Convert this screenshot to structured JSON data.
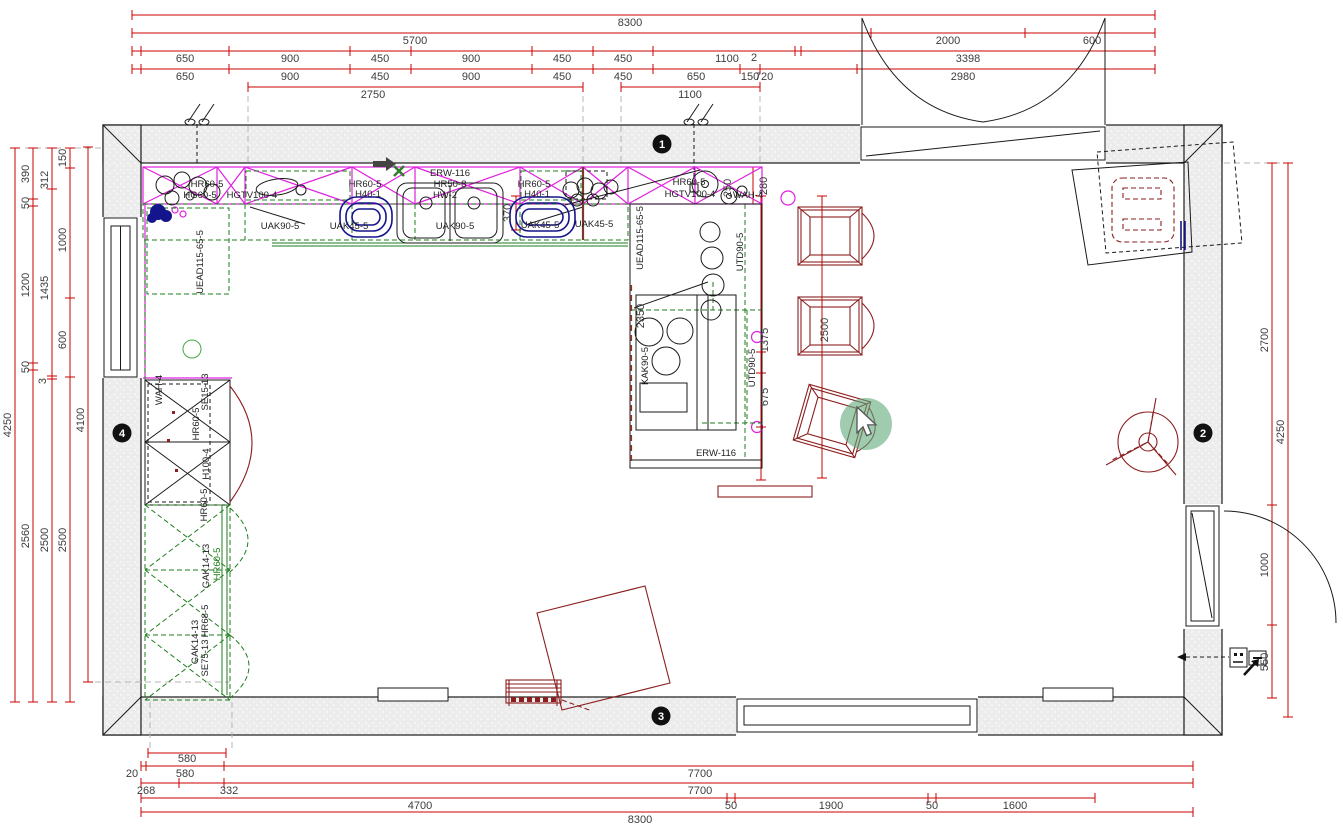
{
  "canvas": {
    "width": 1343,
    "height": 831,
    "background": "#ffffff"
  },
  "colors": {
    "dimension_red": "#c80000",
    "furniture_dark_red": "#8b1e1e",
    "wall_cabinet_magenta": "#e020e0",
    "installation_green": "#1e7d1e",
    "radiator_navy": "#14148c",
    "accent_brown": "#7a3a2a",
    "wall_fill_gray": "#ececec",
    "marker_black": "#111111",
    "click_highlight_green": "#5fa97a"
  },
  "cursor": {
    "icon": "pointer-arrow-icon",
    "highlight": "click-highlight-circle"
  },
  "plan": {
    "wall_markers": [
      {
        "t": "1",
        "x": 662,
        "y": 144
      },
      {
        "t": "2",
        "x": 1203,
        "y": 433
      },
      {
        "t": "3",
        "x": 661,
        "y": 716
      },
      {
        "t": "4",
        "x": 122,
        "y": 433
      }
    ],
    "dim_labels": [
      {
        "t": "8300",
        "x": 630,
        "y": 26
      },
      {
        "t": "5700",
        "x": 415,
        "y": 44
      },
      {
        "t": "2000",
        "x": 948,
        "y": 44
      },
      {
        "t": "600",
        "x": 1092,
        "y": 44
      },
      {
        "t": "650",
        "x": 185,
        "y": 62
      },
      {
        "t": "900",
        "x": 290,
        "y": 62
      },
      {
        "t": "450",
        "x": 380,
        "y": 62
      },
      {
        "t": "900",
        "x": 471,
        "y": 62
      },
      {
        "t": "450",
        "x": 562,
        "y": 62
      },
      {
        "t": "450",
        "x": 623,
        "y": 62
      },
      {
        "t": "1100",
        "x": 727,
        "y": 62
      },
      {
        "t": "2",
        "x": 754,
        "y": 61
      },
      {
        "t": "3398",
        "x": 968,
        "y": 62
      },
      {
        "t": "650",
        "x": 185,
        "y": 80
      },
      {
        "t": "900",
        "x": 290,
        "y": 80
      },
      {
        "t": "450",
        "x": 380,
        "y": 80
      },
      {
        "t": "900",
        "x": 471,
        "y": 80
      },
      {
        "t": "450",
        "x": 562,
        "y": 80
      },
      {
        "t": "450",
        "x": 623,
        "y": 80
      },
      {
        "t": "650",
        "x": 696,
        "y": 80
      },
      {
        "t": "150",
        "x": 750,
        "y": 80
      },
      {
        "t": "720",
        "x": 764,
        "y": 80
      },
      {
        "t": "2980",
        "x": 963,
        "y": 80
      },
      {
        "t": "2750",
        "x": 373,
        "y": 98
      },
      {
        "t": "1100",
        "x": 690,
        "y": 98
      },
      {
        "t": "4250",
        "x": 11,
        "y": 425,
        "rot": true
      },
      {
        "t": "390",
        "x": 29,
        "y": 174,
        "rot": true
      },
      {
        "t": "50",
        "x": 29,
        "y": 203,
        "rot": true
      },
      {
        "t": "1200",
        "x": 29,
        "y": 285,
        "rot": true
      },
      {
        "t": "50",
        "x": 29,
        "y": 367,
        "rot": true
      },
      {
        "t": "2560",
        "x": 29,
        "y": 536,
        "rot": true
      },
      {
        "t": "312",
        "x": 48,
        "y": 180,
        "rot": true
      },
      {
        "t": "1435",
        "x": 48,
        "y": 288,
        "rot": true
      },
      {
        "t": "3",
        "x": 46,
        "y": 381,
        "rot": true
      },
      {
        "t": "2500",
        "x": 48,
        "y": 540,
        "rot": true
      },
      {
        "t": "150",
        "x": 66,
        "y": 158,
        "rot": true
      },
      {
        "t": "1000",
        "x": 66,
        "y": 240,
        "rot": true
      },
      {
        "t": "600",
        "x": 66,
        "y": 340,
        "rot": true
      },
      {
        "t": "2500",
        "x": 66,
        "y": 540,
        "rot": true
      },
      {
        "t": "4100",
        "x": 84,
        "y": 420,
        "rot": true
      },
      {
        "t": "2700",
        "x": 1268,
        "y": 340,
        "rot": true
      },
      {
        "t": "1000",
        "x": 1268,
        "y": 565,
        "rot": true
      },
      {
        "t": "550",
        "x": 1268,
        "y": 662,
        "rot": true
      },
      {
        "t": "4250",
        "x": 1284,
        "y": 432,
        "rot": true
      },
      {
        "t": "580",
        "x": 187,
        "y": 762
      },
      {
        "t": "20",
        "x": 132,
        "y": 777
      },
      {
        "t": "580",
        "x": 185,
        "y": 777
      },
      {
        "t": "7700",
        "x": 700,
        "y": 777
      },
      {
        "t": "268",
        "x": 146,
        "y": 794
      },
      {
        "t": "332",
        "x": 229,
        "y": 794
      },
      {
        "t": "7700",
        "x": 700,
        "y": 794
      },
      {
        "t": "4700",
        "x": 420,
        "y": 809
      },
      {
        "t": "50",
        "x": 731,
        "y": 809
      },
      {
        "t": "1900",
        "x": 831,
        "y": 809
      },
      {
        "t": "50",
        "x": 932,
        "y": 809
      },
      {
        "t": "1600",
        "x": 1015,
        "y": 809
      },
      {
        "t": "8300",
        "x": 640,
        "y": 823
      },
      {
        "t": "370",
        "x": 511,
        "y": 213,
        "rot": true
      },
      {
        "t": "2500",
        "x": 828,
        "y": 330,
        "rot": true
      },
      {
        "t": "1375",
        "x": 768,
        "y": 340,
        "rot": true
      },
      {
        "t": "675",
        "x": 768,
        "y": 397,
        "rot": true
      },
      {
        "t": "250",
        "x": 731,
        "y": 188,
        "rot": true
      },
      {
        "t": "280",
        "x": 767,
        "y": 186,
        "rot": true,
        "dark": true
      },
      {
        "t": "2350",
        "x": 644,
        "y": 316,
        "rot": true,
        "dark": true
      }
    ],
    "cabinet_labels": [
      {
        "t": "HR60-5",
        "x": 207,
        "y": 187
      },
      {
        "t": "HG60-5",
        "x": 200,
        "y": 198
      },
      {
        "t": "HGTV100-4",
        "x": 252,
        "y": 198
      },
      {
        "t": "HR60-5",
        "x": 365,
        "y": 187
      },
      {
        "t": "H40-1",
        "x": 368,
        "y": 197
      },
      {
        "t": "ERW-116",
        "x": 450,
        "y": 176
      },
      {
        "t": "HR50-8",
        "x": 450,
        "y": 187
      },
      {
        "t": "HW-2",
        "x": 445,
        "y": 198
      },
      {
        "t": "HR60-5",
        "x": 534,
        "y": 187
      },
      {
        "t": "H40-1",
        "x": 537,
        "y": 197
      },
      {
        "t": "HR60-5",
        "x": 689,
        "y": 185
      },
      {
        "t": "HGTV100-4",
        "x": 690,
        "y": 197
      },
      {
        "t": "WAH-4",
        "x": 748,
        "y": 198
      },
      {
        "t": "UAK90-5",
        "x": 280,
        "y": 229
      },
      {
        "t": "UAK45-5",
        "x": 349,
        "y": 229
      },
      {
        "t": "UAK90-5",
        "x": 455,
        "y": 229
      },
      {
        "t": "UAK45-5",
        "x": 540,
        "y": 228
      },
      {
        "t": "UAK45-5",
        "x": 594,
        "y": 227
      },
      {
        "t": "ERW-116",
        "x": 716,
        "y": 456
      },
      {
        "t": "UEAD115-65-5",
        "x": 203,
        "y": 262,
        "rot": true
      },
      {
        "t": "UEAD115-65-5",
        "x": 643,
        "y": 238,
        "rot": true
      },
      {
        "t": "KAK90-5",
        "x": 648,
        "y": 366,
        "rot": true
      },
      {
        "t": "UTD90-5",
        "x": 743,
        "y": 252,
        "rot": true
      },
      {
        "t": "UTD90-5",
        "x": 755,
        "y": 368,
        "rot": true
      },
      {
        "t": "WAH-4",
        "x": 162,
        "y": 390,
        "rot": true
      },
      {
        "t": "SE15-13",
        "x": 208,
        "y": 392,
        "rot": true
      },
      {
        "t": "HR60-5",
        "x": 199,
        "y": 424,
        "rot": true
      },
      {
        "t": "H100-4",
        "x": 209,
        "y": 464,
        "rot": true
      },
      {
        "t": "HR60-5",
        "x": 207,
        "y": 505,
        "rot": true
      },
      {
        "t": "GAK14-13",
        "x": 209,
        "y": 566,
        "rot": true
      },
      {
        "t": "HR60-5",
        "x": 220,
        "y": 564,
        "rot": true,
        "green": true
      },
      {
        "t": "GAK14-13",
        "x": 198,
        "y": 642,
        "rot": true
      },
      {
        "t": "HR68-5",
        "x": 208,
        "y": 621,
        "rot": true
      },
      {
        "t": "SE75-13",
        "x": 208,
        "y": 658,
        "rot": true
      }
    ]
  }
}
